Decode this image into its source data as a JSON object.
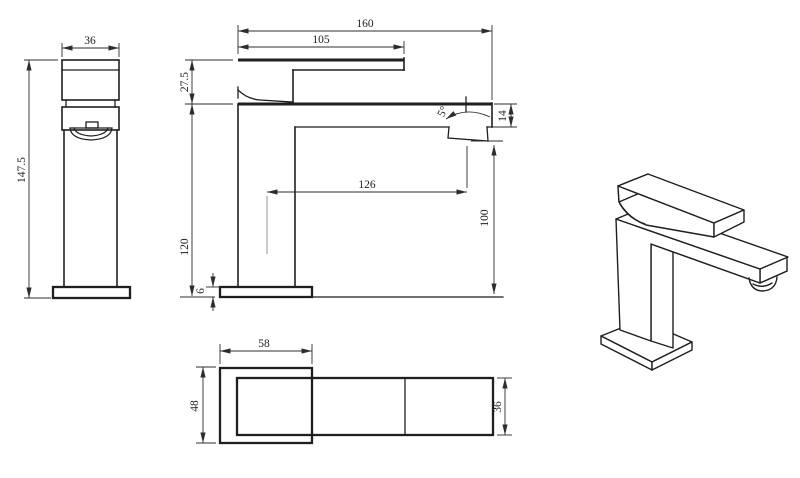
{
  "drawing": {
    "product": "square single-lever basin mixer tap",
    "colors": {
      "line": "#1f1f1f",
      "background": "#ffffff"
    },
    "views": {
      "front": {
        "handle_width": "36",
        "total_height": "147.5"
      },
      "side": {
        "total_length": "160",
        "handle_length": "105",
        "handle_height": "27.5",
        "body_height": "120",
        "spout_reach": "126",
        "outlet_height": "100",
        "spout_end_height": "14",
        "base_thickness": "6",
        "aerator_angle": "5°"
      },
      "plan": {
        "base_length": "58",
        "base_width": "48",
        "spout_width": "36"
      }
    }
  }
}
